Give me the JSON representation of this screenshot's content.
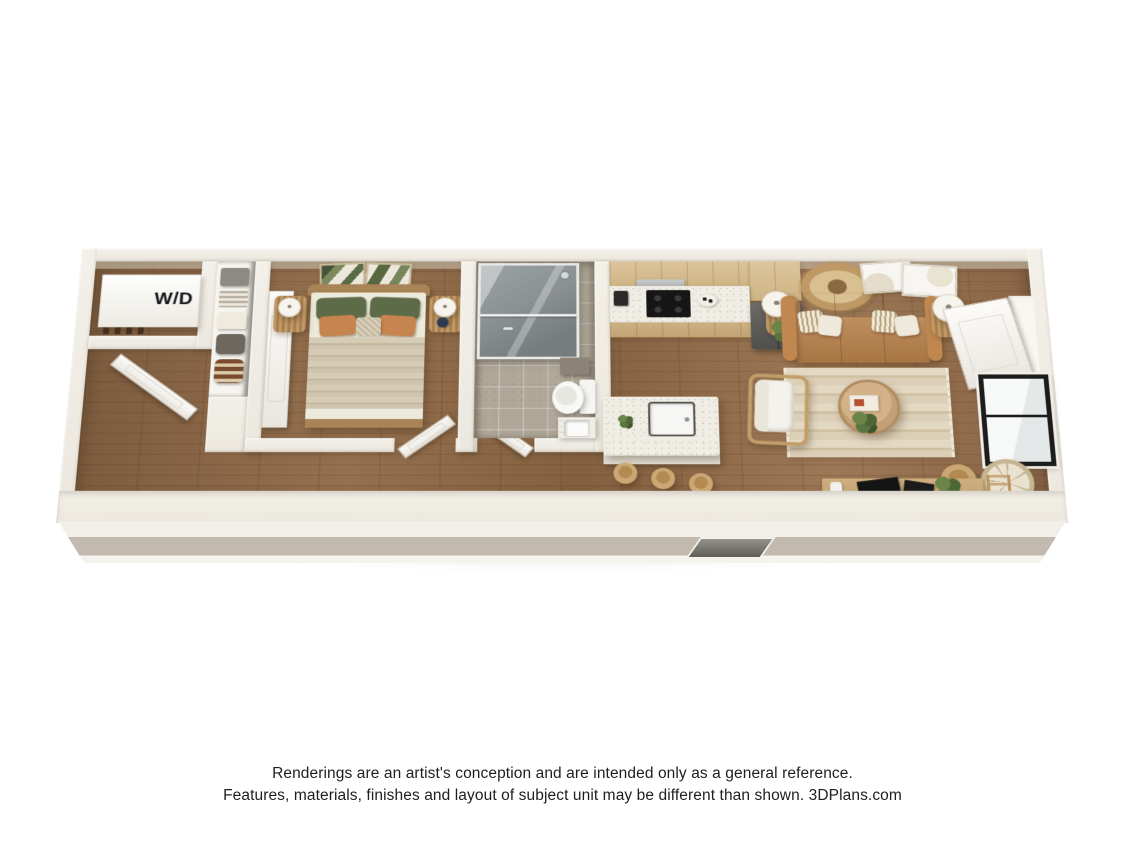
{
  "floorplan": {
    "washer_dryer_label": "W/D",
    "colors": {
      "wall_top": "#f3f0e9",
      "floor_wood": "#94704e",
      "floor_wood_dark": "#7d5c3f",
      "bathroom_tile": "#b0a798",
      "countertop": "#f0ede5",
      "cabinet_wood": "#dcc49c",
      "refrigerator": "#605f5b",
      "cooktop": "#161616",
      "sofa_leather": "#c08850",
      "sofa_seat": "#b67f49",
      "rug": "#dccfb7",
      "bed_blanket": "#cfc4ad",
      "bed_sheet": "#eceadb",
      "pillow_green": "#5d6b48",
      "pillow_rust": "#c6854e",
      "headboard_wood": "#a98457",
      "window_frame": "#1c1c1c",
      "shower_glass": "#8b9193",
      "front_wall_stripe": "#c2baae"
    }
  },
  "disclaimer": {
    "line1": "Renderings are an artist's conception and are intended only as a general reference.",
    "line2": "Features, materials, finishes and layout of subject unit may be different than shown. 3DPlans.com"
  }
}
